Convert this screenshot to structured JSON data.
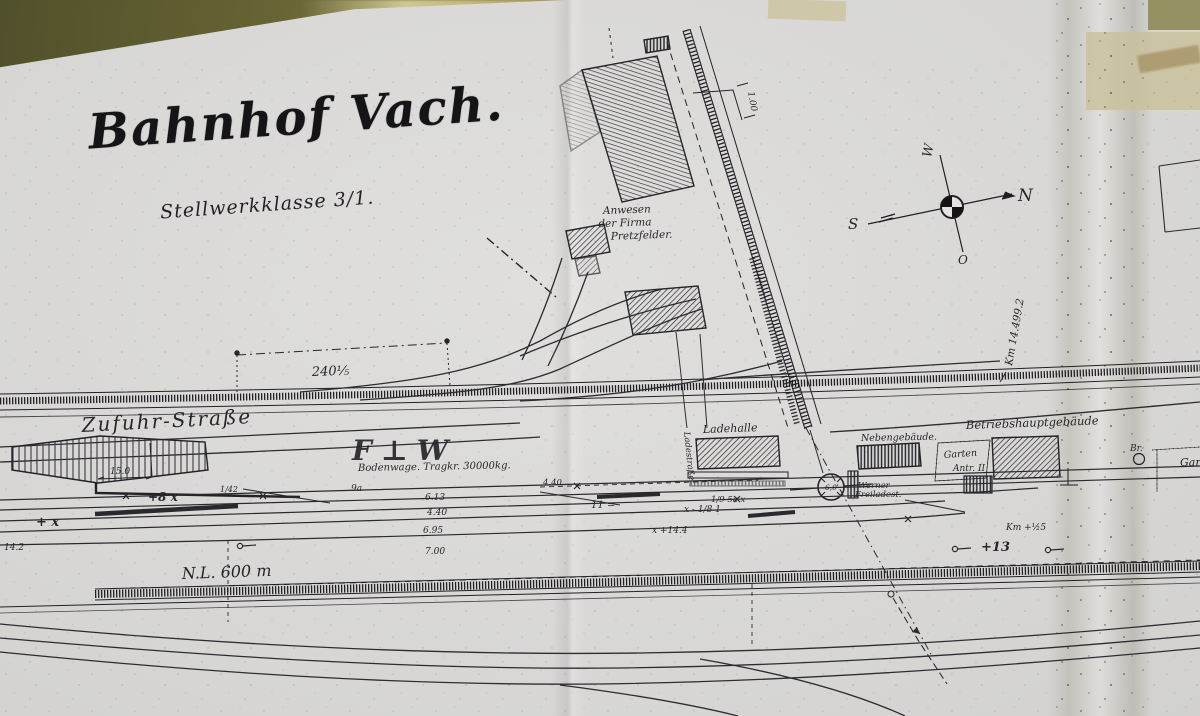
{
  "scan": {
    "title": "Bahnhof Vach.",
    "subtitle": "Stellwerkklasse 3/1."
  },
  "compass": {
    "n": "N",
    "s": "S",
    "w": "W",
    "o": "O"
  },
  "industrial": {
    "premises_line1": "Anwesen",
    "premises_line2": "der Firma",
    "premises_line3": "Pretzfelder.",
    "siding_dim": "1.00"
  },
  "roads": {
    "supply_road": "Zufuhr-Straße",
    "loading_road": "Ladestraße"
  },
  "mainline": {
    "km_mark": "Km 14.499.2",
    "dim_240": "240⅕"
  },
  "station": {
    "loading_hall": "Ladehalle",
    "aux_building": "Nebengebäude.",
    "main_building": "Betriebshauptgebäude",
    "garden_line1": "Garten",
    "garden_line2": "Antr. II",
    "well": "Br.",
    "garden_right": "Gar",
    "freight_line1": "Werner",
    "freight_line2": "Freiladest.",
    "turntable_diameter": "6,0",
    "scale_note": "Bodenwage. Tragkr. 30000kg.",
    "usable_length": "N.L. 600 m",
    "ramp_dim": "15.0",
    "signal_marks": "F⊥W"
  },
  "measures": {
    "m1": "+8  x",
    "m2": "+   x",
    "m3": "14.2",
    "m4": "1/42",
    "m5": "9a",
    "m6": "6.13",
    "m7": "4.40",
    "m8": "6.95",
    "m9": "7.00",
    "m10": "11 =",
    "m11": "4.40",
    "m12": "x - 1/8 1",
    "m13": "1/9 5a  x",
    "m14": "x +14.4",
    "m15": "Km +½5",
    "m16": "+13"
  }
}
